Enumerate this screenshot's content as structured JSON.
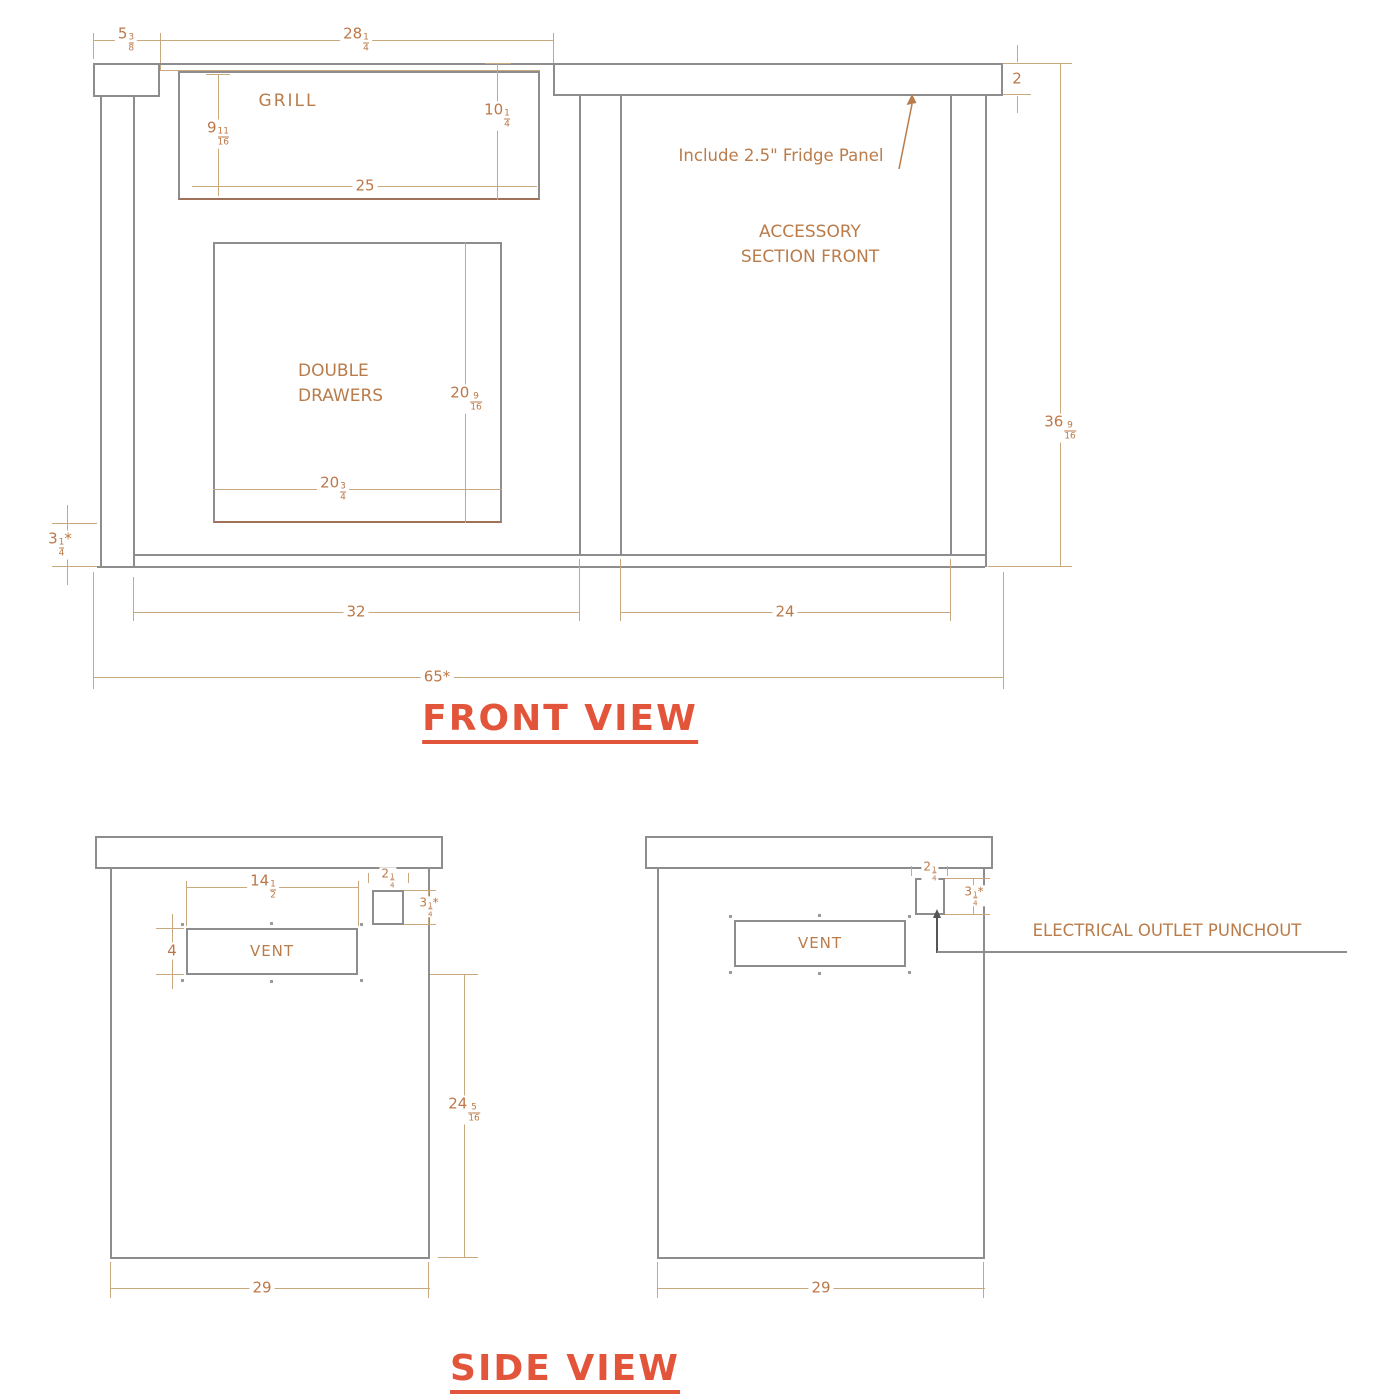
{
  "titles": {
    "front": "FRONT VIEW",
    "side": "SIDE VIEW"
  },
  "colors": {
    "structure": "#8d8d8d",
    "dimline": "#c9a87e",
    "dimtext": "#bd7848",
    "note": "#b97c4a",
    "title": "#e2553a"
  },
  "front_view": {
    "labels": {
      "grill": "GRILL",
      "double_drawers_line1": "DOUBLE",
      "double_drawers_line2": "DRAWERS",
      "accessory_line1": "ACCESSORY",
      "accessory_line2": "SECTION FRONT",
      "fridge_panel_note": "Include 2.5\" Fridge Panel"
    },
    "dims": {
      "counter_overhang": {
        "w": "5",
        "n": "3",
        "d": "8"
      },
      "grill_cutout_width": {
        "w": "28",
        "n": "1",
        "d": "4"
      },
      "counter_thickness": {
        "w": "2"
      },
      "grill_depth_left": {
        "w": "9",
        "n": "11",
        "d": "16"
      },
      "grill_depth_right": {
        "w": "10",
        "n": "1",
        "d": "4"
      },
      "grill_bottom_width": {
        "w": "25"
      },
      "drawers_height": {
        "w": "20",
        "n": "9",
        "d": "16"
      },
      "drawers_width": {
        "w": "20",
        "n": "3",
        "d": "4"
      },
      "overall_height": {
        "w": "36",
        "n": "9",
        "d": "16"
      },
      "base_height": {
        "w": "3",
        "n": "1",
        "d": "4",
        "s": "*"
      },
      "grill_section_width": {
        "w": "32"
      },
      "accessory_section_width": {
        "w": "24"
      },
      "overall_width": {
        "w": "65",
        "s": "*"
      }
    }
  },
  "side_view_left": {
    "labels": {
      "vent": "VENT"
    },
    "dims": {
      "vent_width": {
        "w": "14",
        "n": "1",
        "d": "2"
      },
      "vent_height": {
        "w": "4"
      },
      "punchout_width": {
        "w": "2",
        "n": "1",
        "d": "4"
      },
      "punchout_height": {
        "w": "3",
        "n": "1",
        "d": "4",
        "s": "*"
      },
      "lower_height": {
        "w": "24",
        "n": "5",
        "d": "16"
      },
      "depth": {
        "w": "29"
      }
    }
  },
  "side_view_right": {
    "labels": {
      "vent": "VENT",
      "punchout_note": "ELECTRICAL OUTLET PUNCHOUT"
    },
    "dims": {
      "punchout_width": {
        "w": "2",
        "n": "1",
        "d": "4"
      },
      "punchout_height": {
        "w": "3",
        "n": "1",
        "d": "4",
        "s": "*"
      },
      "depth": {
        "w": "29"
      }
    }
  }
}
